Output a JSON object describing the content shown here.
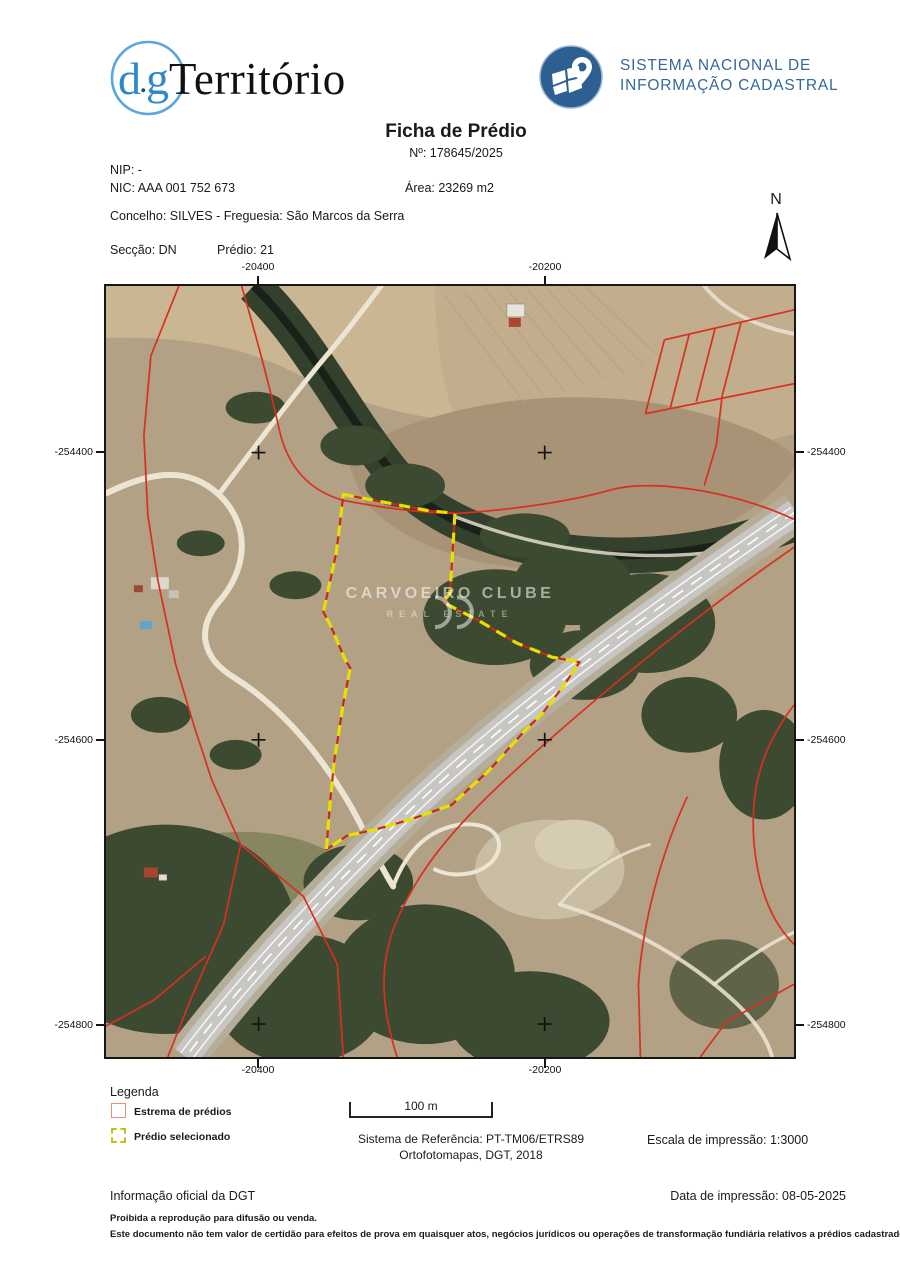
{
  "header": {
    "dgt_logo": {
      "d": "d",
      "dot": ".",
      "g": "g",
      "name": "Território",
      "circle_color": "#58a8dd",
      "text_color": "#2f88c9"
    },
    "snic_logo": {
      "line1": "SISTEMA NACIONAL DE",
      "line2": "INFORMAÇÃO CADASTRAL",
      "text_color": "#35689c",
      "badge_color": "#2d5f93"
    },
    "title": "Ficha de Prédio",
    "doc_number": "Nº: 178645/2025"
  },
  "property": {
    "nip": "NIP: -",
    "nic": "NIC: AAA 001 752 673",
    "area": "Área: 23269 m2",
    "municipality": "Concelho: SILVES - Freguesia: São Marcos da Serra",
    "section": "Secção: DN",
    "parcel": "Prédio: 21"
  },
  "compass": {
    "north_label": "N"
  },
  "map": {
    "x_tick_labels": [
      "-20400",
      "-20200"
    ],
    "y_tick_labels": [
      "-254400",
      "-254600",
      "-254800"
    ],
    "watermark": {
      "line1": "CARVOEIRO CLUBE",
      "line2": "REAL ESTATE"
    },
    "colors": {
      "parcel_boundary_red": "#d92f20",
      "selected_parcel_yellow": "#e8e000",
      "selected_underlay_red": "#c52a1c"
    },
    "graticule_crosses": [
      [
        153,
        167
      ],
      [
        440,
        167
      ],
      [
        153,
        455
      ],
      [
        440,
        455
      ],
      [
        153,
        740
      ],
      [
        440,
        740
      ]
    ],
    "selected_parcel_points": "238,209 322,225 350,228 345,308 338,317 373,335 412,358 447,372 475,377 458,402 438,428 418,448 400,468 383,487 365,503 347,520 305,535 270,545 242,551 221,565 225,515 229,475 232,457 238,418 245,383 240,375 225,340 218,327 225,295 231,267 235,235",
    "boundary_lines": [
      "M 73,0 L 45,70 L 38,150 L 42,230 L 52,295 L 70,380 L 88,440 L 106,495 L 135,560 L 118,640 L 85,715 L 62,773",
      "M 135,560 L 198,612 L 232,680 L 238,773",
      "M 100,672 L 48,716 L 0,742",
      "M 136,0 C 152,55 164,100 174,145 C 184,188 210,207 238,215 C 292,225 330,228 352,228 C 410,224 466,216 508,204 C 556,192 640,210 690,234",
      "M 560,54 L 541,128",
      "M 585,48 L 566,122",
      "M 611,42 L 592,116",
      "M 637,36 L 618,110",
      "M 560,54 L 690,24",
      "M 541,128 L 690,98",
      "M 618,110 L 612,160 L 600,200",
      "M 690,262 C 580,338 470,430 395,500 C 340,552 310,592 290,640 C 272,685 278,730 292,773",
      "M 583,512 C 556,570 538,640 534,700 L 536,773",
      "M 690,700 L 622,738 L 596,773",
      "M 690,420 C 660,460 645,500 650,560 C 655,610 670,640 690,660"
    ]
  },
  "legend": {
    "title": "Legenda",
    "items": [
      {
        "label": "Estrema de prédios",
        "swatch": "red-outline-square"
      },
      {
        "label": "Prédio selecionado",
        "swatch": "yellow-dashed-square"
      }
    ]
  },
  "scale_bar": {
    "label": "100 m"
  },
  "reference": {
    "line1": "Sistema de Referência: PT-TM06/ETRS89",
    "line2": "Ortofotomapas, DGT, 2018"
  },
  "print_scale": "Escala de impressão: 1:3000",
  "footer": {
    "official": "Informação oficial da DGT",
    "print_date": "Data de impressão: 08-05-2025",
    "notice1": "Proibida a reprodução para difusão ou venda.",
    "notice2": "Este documento não tem valor de certidão para efeitos de prova em quaisquer atos, negócios jurídicos ou operações de transformação fundiária relativos a prédios cadastrados."
  }
}
